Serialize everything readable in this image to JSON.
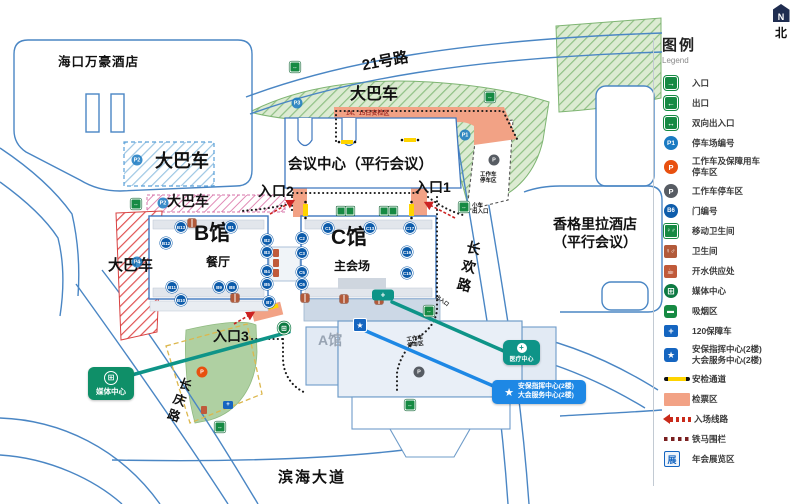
{
  "legend": {
    "title": "图例",
    "subtitle": "Legend",
    "north_n": "N",
    "north_label": "北",
    "items": [
      {
        "icon": "in",
        "glyph": "→",
        "label": "入口"
      },
      {
        "icon": "out",
        "glyph": "←",
        "label": "出口"
      },
      {
        "icon": "both",
        "glyph": "↔",
        "label": "双向出入口"
      },
      {
        "icon": "p-blue",
        "glyph": "P1",
        "label": "停车场编号"
      },
      {
        "icon": "p-orange",
        "glyph": "P",
        "label": "工作车及保障用车",
        "label2": "停车区"
      },
      {
        "icon": "p-gray",
        "glyph": "P",
        "label": "工作车停车区"
      },
      {
        "icon": "door-num",
        "glyph": "B6",
        "label": "门编号"
      },
      {
        "icon": "mobile-toilet",
        "glyph": "♀♂",
        "label": "移动卫生间"
      },
      {
        "icon": "toilet",
        "glyph": "♀♂",
        "label": "卫生间"
      },
      {
        "icon": "water",
        "glyph": "☕",
        "label": "开水供应处"
      },
      {
        "icon": "media",
        "glyph": "⊞",
        "label": "媒体中心"
      },
      {
        "icon": "smoking",
        "glyph": "▬",
        "label": "吸烟区"
      },
      {
        "icon": "ambulance",
        "glyph": "+",
        "label": "120保障车"
      },
      {
        "icon": "star",
        "glyph": "★",
        "label": "安保指挥中心(2楼)",
        "label2": "大会服务中心(2楼)"
      },
      {
        "icon": "security-line",
        "glyph": "",
        "label": "安检通道"
      },
      {
        "icon": "ticket-area",
        "glyph": "",
        "label": "检票区"
      },
      {
        "icon": "route",
        "glyph": "",
        "label": "入场线路"
      },
      {
        "icon": "barrier",
        "glyph": "",
        "label": "铁马围栏"
      },
      {
        "icon": "expo",
        "glyph": "展",
        "label": "年会展览区"
      }
    ]
  },
  "map": {
    "labels": {
      "marriott": "海口万豪酒店",
      "bus_blue": "大巴车",
      "bus_green": "大巴车",
      "bus_pink": "大巴车",
      "bus_red": "大巴车",
      "road21": "21号路",
      "cp1415": "14、15日安检区",
      "conference": "会议中心（平行会议）",
      "entrance1": "入口1",
      "entrance2": "入口2",
      "entrance3": "入口3",
      "small_car_1": "小车",
      "small_car_2": "出入口",
      "work_tr_1": "工作车",
      "work_tr_2": "停车区",
      "work_br_1": "工作车",
      "work_br_2": "停车区",
      "hall_b": "B馆",
      "hall_b_sub": "餐厅",
      "hall_c": "C馆",
      "hall_c_sub": "主会场",
      "hall_a": "A馆",
      "changhuan": "长欢路",
      "changqing": "长庆路",
      "shangrila_1": "香格里拉酒店",
      "shangrila_2": "（平行会议）",
      "binhai": "滨海大道",
      "exit_small": "出入口"
    },
    "callouts": {
      "media": "媒体中心",
      "medical": "医疗中心",
      "security_1": "安保指挥中心(2楼)",
      "security_2": "大会服务中心(2楼)"
    },
    "door_badges": [
      {
        "label": "B13",
        "x": 181,
        "y": 227
      },
      {
        "label": "B1",
        "x": 231,
        "y": 227
      },
      {
        "label": "B12",
        "x": 166,
        "y": 243
      },
      {
        "label": "B11",
        "x": 172,
        "y": 287
      },
      {
        "label": "B10",
        "x": 181,
        "y": 300
      },
      {
        "label": "B9",
        "x": 219,
        "y": 287
      },
      {
        "label": "B8",
        "x": 232,
        "y": 287
      },
      {
        "label": "B7",
        "x": 269,
        "y": 302
      },
      {
        "label": "B2",
        "x": 267,
        "y": 240
      },
      {
        "label": "B3",
        "x": 267,
        "y": 252
      },
      {
        "label": "B4",
        "x": 267,
        "y": 271
      },
      {
        "label": "B5",
        "x": 267,
        "y": 284
      },
      {
        "label": "C1",
        "x": 328,
        "y": 228
      },
      {
        "label": "C13",
        "x": 370,
        "y": 228
      },
      {
        "label": "C17",
        "x": 410,
        "y": 228
      },
      {
        "label": "C2",
        "x": 302,
        "y": 238
      },
      {
        "label": "C3",
        "x": 302,
        "y": 253
      },
      {
        "label": "C5",
        "x": 302,
        "y": 272
      },
      {
        "label": "C6",
        "x": 302,
        "y": 284
      },
      {
        "label": "C16",
        "x": 407,
        "y": 252
      },
      {
        "label": "C15",
        "x": 407,
        "y": 273
      }
    ],
    "parking_badges": [
      {
        "label": "P3",
        "x": 297,
        "y": 103,
        "cls": "p-blue"
      },
      {
        "label": "P1",
        "x": 465,
        "y": 135,
        "cls": "p-blue"
      },
      {
        "label": "P2",
        "x": 137,
        "y": 160,
        "cls": "p-blue"
      },
      {
        "label": "P2",
        "x": 163,
        "y": 203,
        "cls": "p-blue"
      },
      {
        "label": "P4",
        "x": 137,
        "y": 262,
        "cls": "p-blue"
      },
      {
        "label": "P",
        "x": 202,
        "y": 372,
        "cls": "p-orange"
      },
      {
        "label": "P",
        "x": 494,
        "y": 160,
        "cls": "p-gray"
      },
      {
        "label": "P",
        "x": 419,
        "y": 372,
        "cls": "p-gray"
      }
    ],
    "icons": [
      {
        "name": "gate-icon",
        "cls": "mi-gate",
        "glyph": "↔",
        "x": 295,
        "y": 67
      },
      {
        "name": "gate-icon",
        "cls": "mi-gate",
        "glyph": "↔",
        "x": 490,
        "y": 97
      },
      {
        "name": "gate-icon",
        "cls": "mi-gate",
        "glyph": "↔",
        "x": 464,
        "y": 207
      },
      {
        "name": "gate-icon",
        "cls": "mi-gate",
        "glyph": "↔",
        "x": 429,
        "y": 311
      },
      {
        "name": "gate-icon",
        "cls": "mi-gate",
        "glyph": "↔",
        "x": 220,
        "y": 427
      },
      {
        "name": "gate-icon",
        "cls": "mi-gate",
        "glyph": "↔",
        "x": 410,
        "y": 405
      },
      {
        "name": "gate-icon",
        "cls": "mi-gate",
        "glyph": "↔",
        "x": 136,
        "y": 204
      },
      {
        "name": "mobile-toilet-icon",
        "cls": "mi-mt",
        "glyph": "",
        "x": 341,
        "y": 211
      },
      {
        "name": "mobile-toilet-icon",
        "cls": "mi-mt",
        "glyph": "",
        "x": 350,
        "y": 211
      },
      {
        "name": "mobile-toilet-icon",
        "cls": "mi-mt",
        "glyph": "",
        "x": 384,
        "y": 211
      },
      {
        "name": "mobile-toilet-icon",
        "cls": "mi-mt",
        "glyph": "",
        "x": 393,
        "y": 211
      },
      {
        "name": "toilet-icon",
        "cls": "mi-toilet",
        "glyph": "",
        "x": 192,
        "y": 223
      },
      {
        "name": "toilet-icon",
        "cls": "mi-toilet",
        "glyph": "",
        "x": 235,
        "y": 298
      },
      {
        "name": "toilet-icon",
        "cls": "mi-toilet",
        "glyph": "",
        "x": 305,
        "y": 298
      },
      {
        "name": "toilet-icon",
        "cls": "mi-toilet",
        "glyph": "",
        "x": 344,
        "y": 299
      },
      {
        "name": "toilet-icon",
        "cls": "mi-toilet",
        "glyph": "",
        "x": 379,
        "y": 300
      },
      {
        "name": "water-supply-icon",
        "cls": "mi-water",
        "glyph": "",
        "x": 276,
        "y": 253
      },
      {
        "name": "water-supply-icon",
        "cls": "mi-water",
        "glyph": "",
        "x": 276,
        "y": 263
      },
      {
        "name": "water-supply-icon",
        "cls": "mi-water",
        "glyph": "",
        "x": 276,
        "y": 273
      },
      {
        "name": "water-supply-icon",
        "cls": "mi-water",
        "glyph": "",
        "x": 204,
        "y": 410
      },
      {
        "name": "ambulance-icon",
        "cls": "mi-amb",
        "glyph": "+",
        "x": 228,
        "y": 405
      },
      {
        "name": "media-center-icon",
        "cls": "mi-media-pt",
        "glyph": "⊞",
        "x": 284,
        "y": 328
      },
      {
        "name": "security-center-icon",
        "cls": "mi-star",
        "glyph": "★",
        "x": 360,
        "y": 325
      },
      {
        "name": "medical-point-icon",
        "cls": "mi-medpt",
        "glyph": "+",
        "x": 383,
        "y": 295
      }
    ]
  }
}
